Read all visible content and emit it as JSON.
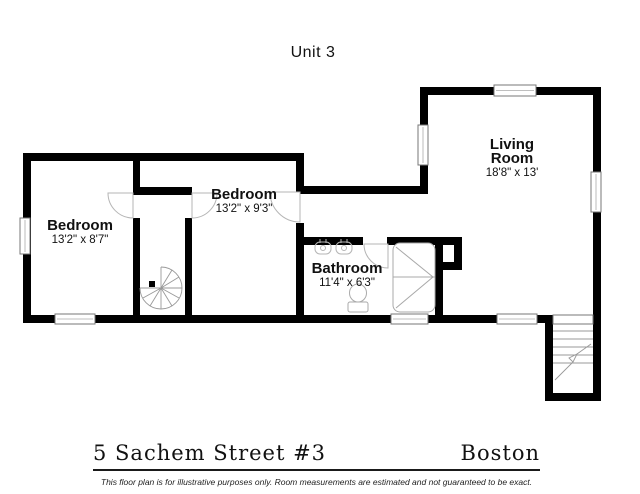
{
  "title": "Unit 3",
  "rooms": [
    {
      "name": "Bedroom",
      "dims": "13'2\" x 8'7\""
    },
    {
      "name": "Bedroom",
      "dims": "13'2\" x 9'3\""
    },
    {
      "name": "Bathroom",
      "dims": "11'4\" x 6'3\""
    },
    {
      "name": "Living Room",
      "dims": "18'8\" x 13'"
    }
  ],
  "footer": {
    "address": "5 Sachem Street #3",
    "city": "Boston",
    "disclaimer": "This floor plan is for illustrative purposes only. Room measurements are estimated and not guaranteed to be exact."
  },
  "colors": {
    "walls": "#000000",
    "fixtures": "#aaaaaa",
    "text": "#111111",
    "background": "#ffffff"
  }
}
